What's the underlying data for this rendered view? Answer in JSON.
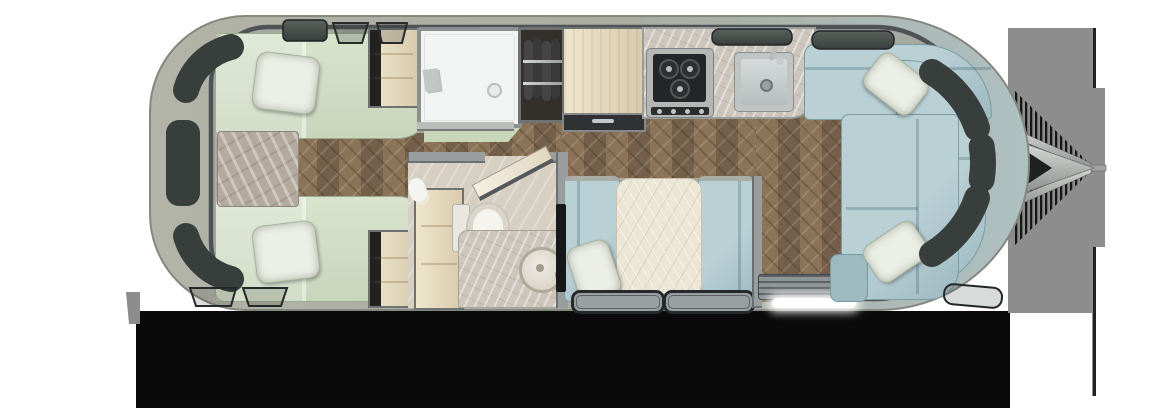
{
  "meta": {
    "type": "travel-trailer-floor-plan",
    "view": "top-down",
    "hitch_side": "right",
    "render_style": "photoreal-3d"
  },
  "areas": [
    "rear-bedroom",
    "bathroom",
    "wardrobes",
    "galley",
    "dinette",
    "entry",
    "front-lounge",
    "hitch"
  ],
  "furniture": [
    "twin-bed-top",
    "twin-bed-bottom",
    "nightstand",
    "bed-pillow-top",
    "bed-pillow-bottom",
    "wardrobe-top",
    "wardrobe-bottom",
    "shower",
    "hanging-closet",
    "refrigerator-pantry",
    "galley-counter",
    "cooktop",
    "galley-sink",
    "bathroom-vanity",
    "toilet",
    "bathroom-sink-counter",
    "bathroom-door",
    "dinette-bench-left",
    "dinette-bench-right",
    "dinette-table",
    "dinette-pillow",
    "tv-panel",
    "dinette-floor-mat-left",
    "dinette-floor-mat-right",
    "entry-step-mat",
    "entry-light-strip",
    "wraparound-sofa",
    "sofa-chaise",
    "sofa-pillow-top",
    "sofa-pillow-bottom",
    "hitch-a-frame",
    "propane-tank-cover",
    "tongue-jack"
  ],
  "colors": {
    "bg": "#ffffff",
    "shadow": "#0a0a0a",
    "shadow_gray": "#8d8d8d",
    "shell_light": "#c6c8bd",
    "shell_mid": "#aaad a2",
    "shell_rear": "#b2b4a8",
    "shell_front": "#aec0c1",
    "shell_edge": "#85887f",
    "sill": "#a6a99f",
    "rim": "#4f5355",
    "window": "#383e3b",
    "window_hi": "#5a625e",
    "wood": "#8b7357",
    "wood_dark": "#74604a",
    "bedding": "#c8d6bb",
    "bedding_hi": "#d9e3cd",
    "drape": "#c8d6ba",
    "pillow": "#ecefe6",
    "marble_tan": "#b4aa9e",
    "cream": "#efe6cf",
    "cream_dark": "#d9cbab",
    "cabinet_frame": "#6e7273",
    "white_room": "#f2f4f3",
    "closet_dark": "#332f2b",
    "garment": "#454545",
    "steel": "#c0c4c3",
    "steel_dark": "#8b8f8f",
    "stove_dark": "#232527",
    "counter": "#ccc6bc",
    "blue": "#b9d0d5",
    "blue_dark": "#9dbac1",
    "table_cream": "#ece6d6",
    "bath_floor": "#d6cfc2",
    "wall": "#999d9e",
    "wall_edge": "#6c7071",
    "mat_frame": "#26292b",
    "mat_fill": "#9aa0a2",
    "led": "#ffffff",
    "tv": "#17181a",
    "toilet": "#f6f4ef",
    "hitch_light": "#d6d8d6",
    "hitch_dark": "#8f9190"
  }
}
